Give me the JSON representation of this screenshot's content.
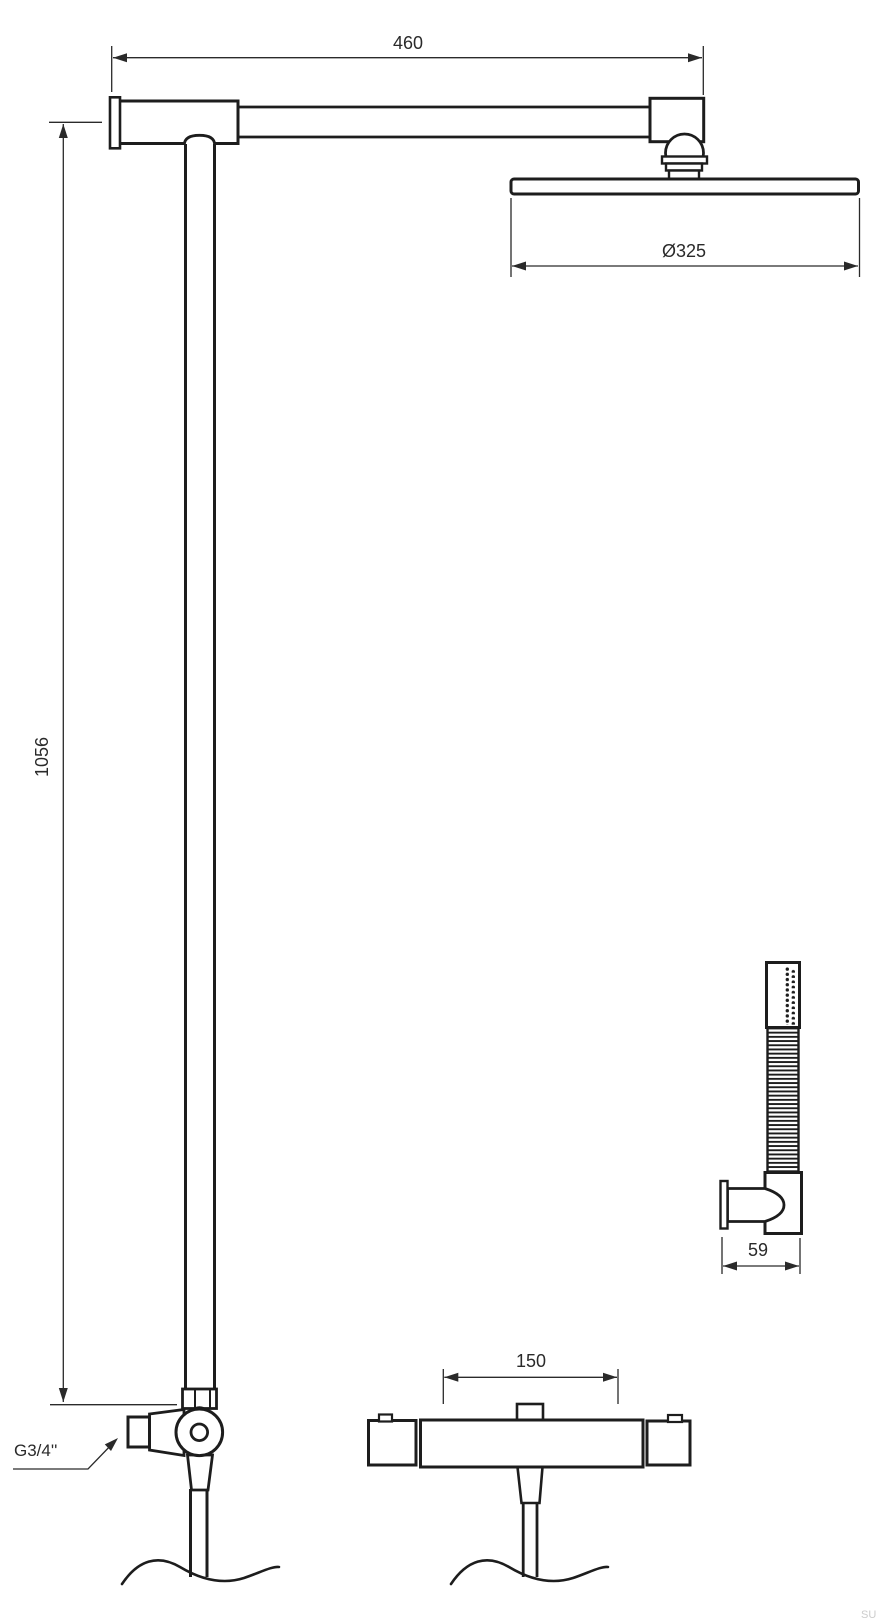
{
  "dimensions": {
    "arm_length": "460",
    "column_height": "1056",
    "head_diameter": "Ø325",
    "mixer_center_distance": "150",
    "handset_bracket_depth": "59",
    "connection_thread": "G3/4''"
  },
  "watermark": "SU",
  "colors": {
    "ink": "#1d1d1d",
    "dimension_lines": "#2a2a2a",
    "watermark_gray": "#cccccc",
    "background": "#ffffff"
  }
}
